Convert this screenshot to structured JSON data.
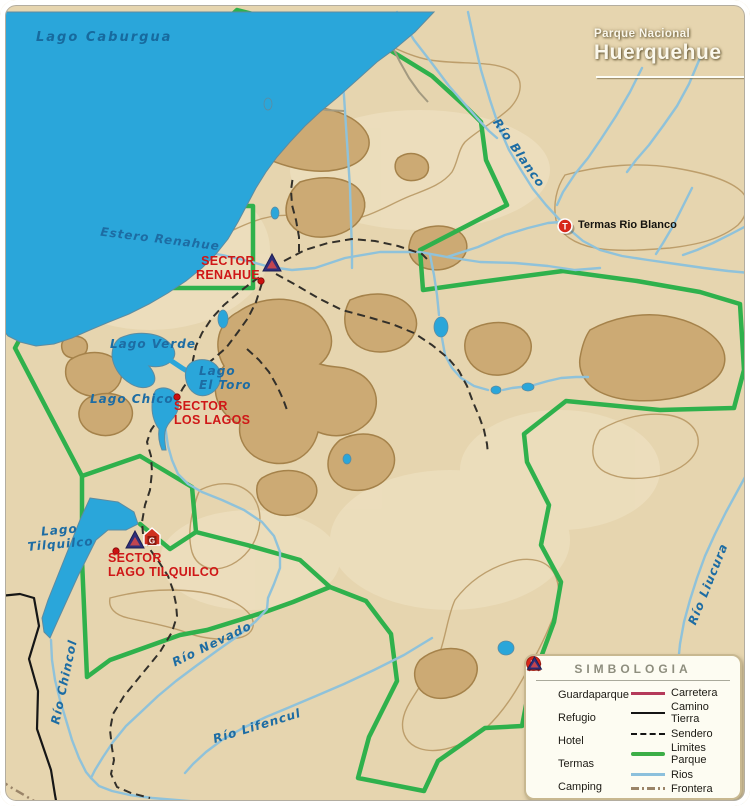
{
  "title": {
    "line1": "Parque Nacional",
    "line2": "Huerquehue"
  },
  "map_labels": {
    "lago_caburgua": "Lago Caburgua",
    "estero_renahue": "Estero Renahue",
    "rio_blanco": "Río Blanco",
    "termas_rio_blanco": "Termas Rio Blanco",
    "sector_renahue_1": "SECTOR",
    "sector_renahue_2": "RENAHUE",
    "lago_verde": "Lago Verde",
    "lago_el_toro_1": "Lago",
    "lago_el_toro_2": "El Toro",
    "lago_chico": "Lago Chico",
    "sector_los_lagos_1": "SECTOR",
    "sector_los_lagos_2": "LOS LAGOS",
    "lago_tilquilco_1": "Lago",
    "lago_tilquilco_2": "Tilquilco",
    "sector_tilquilco_1": "SECTOR",
    "sector_tilquilco_2": "LAGO TILQUILCO",
    "rio_chincol": "Río Chincol",
    "rio_nevado": "Río Nevado",
    "rio_lifencul": "Río Lifencul",
    "rio_liucura": "Río Liucura"
  },
  "legend": {
    "title": "SIMBOLOGIA",
    "point_symbols": [
      {
        "icon": "guardaparque-icon",
        "label": "Guardaparque"
      },
      {
        "icon": "refugio-icon",
        "label": "Refugio"
      },
      {
        "icon": "hotel-icon",
        "label": "Hotel"
      },
      {
        "icon": "termas-icon",
        "label": "Termas"
      },
      {
        "icon": "camping-icon",
        "label": "Camping"
      }
    ],
    "line_symbols": [
      {
        "icon": "carretera-line",
        "label": "Carretera"
      },
      {
        "icon": "camino-tierra-line",
        "label": "Camino Tierra"
      },
      {
        "icon": "sendero-line",
        "label": "Sendero"
      },
      {
        "icon": "limites-parque-line",
        "label": "Limites Parque"
      },
      {
        "icon": "rios-line",
        "label": "Rios"
      },
      {
        "icon": "frontera-line",
        "label": "Frontera"
      }
    ]
  },
  "icon_letters": {
    "guardaparque": "G",
    "hotel": "H",
    "termas": "T"
  },
  "colors": {
    "land": "#e6d5af",
    "land_light": "#f0e4c6",
    "mountain_fill": "#ccaa74",
    "mountain_outline": "#a5824a",
    "lake_blue": "#2aa6da",
    "river_blue": "#8fc2da",
    "park_boundary_green": "#2fb14c",
    "sector_label_red": "#cf1717",
    "water_label_blue": "#1d6ca3",
    "road_black": "#161616",
    "carretera_red": "#b53a5a",
    "frontera_brown": "#9a8468",
    "title_white": "#fbf8ec"
  }
}
